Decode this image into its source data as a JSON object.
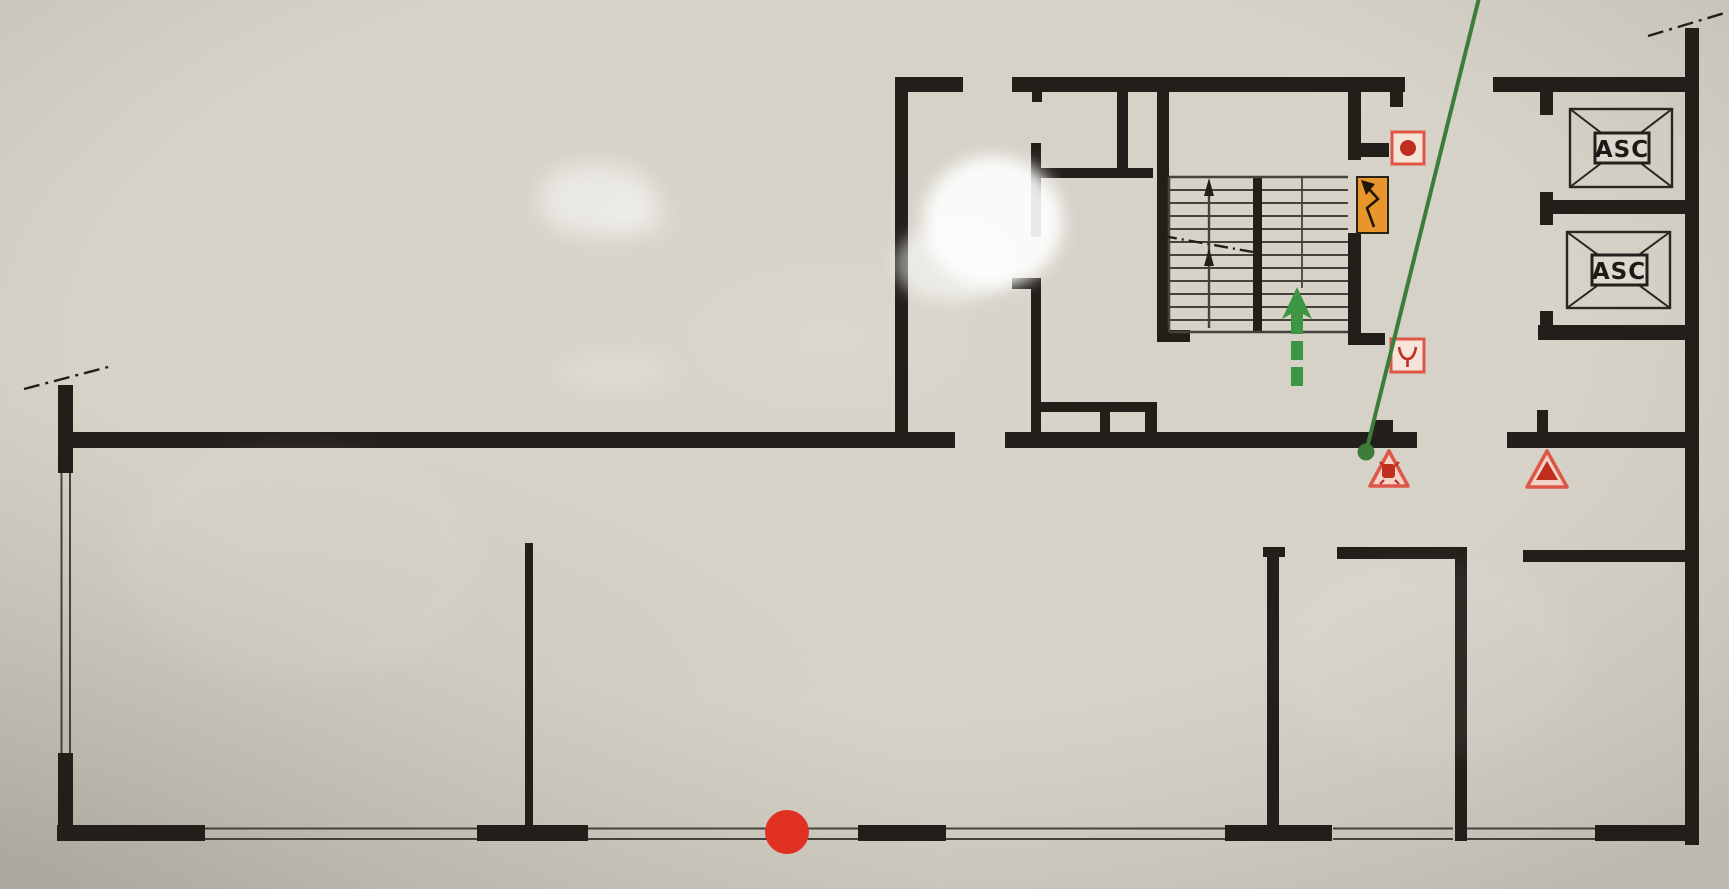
{
  "plan": {
    "title": "Building evacuation floor plan (photographed)",
    "elevators": [
      {
        "label": "ASC"
      },
      {
        "label": "ASC"
      }
    ],
    "colors": {
      "photo_bg": "#d7d3c9",
      "wall": "#221f1b",
      "thin_line": "#45423c",
      "route_green": "#3c7d3c",
      "arrow_green": "#3e9544",
      "alarm_red": "#dd5747",
      "deep_red": "#bf2e1e",
      "assembly_red": "#e03022",
      "panel_orange": "#e8952c",
      "label_bg": "#dcd8cf",
      "symbol_fill": "#f6e3da"
    },
    "symbols": [
      {
        "name": "fire-alarm-call-point-icon"
      },
      {
        "name": "electrical-panel-icon"
      },
      {
        "name": "fire-valve-icon"
      },
      {
        "name": "warning-triangle-device-icon"
      },
      {
        "name": "warning-triangle-icon"
      },
      {
        "name": "location-marker-icon"
      },
      {
        "name": "evacuation-route-line"
      },
      {
        "name": "evacuation-arrow-icon"
      },
      {
        "name": "stair-direction-arrows"
      }
    ]
  }
}
